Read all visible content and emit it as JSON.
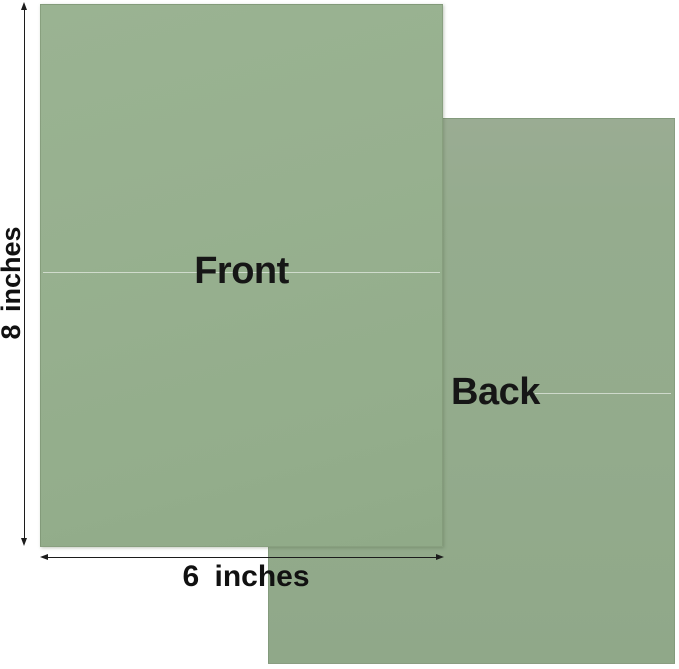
{
  "figure": {
    "type": "product-dimension-diagram",
    "cards": {
      "front": {
        "label": "Front",
        "width_inches": 6,
        "height_inches": 8
      },
      "back": {
        "label": "Back",
        "width_inches": 6,
        "height_inches": 8
      }
    },
    "dimensions": {
      "height_label": "8 inches",
      "width_label": "6 inches"
    },
    "colors": {
      "card_green": "#95ad8e",
      "card_green_dark": "#90a889",
      "background": "#ffffff",
      "text": "#161616",
      "arrow": "#1c1c1c",
      "crease_line": "rgba(255,255,255,0.55)"
    }
  }
}
